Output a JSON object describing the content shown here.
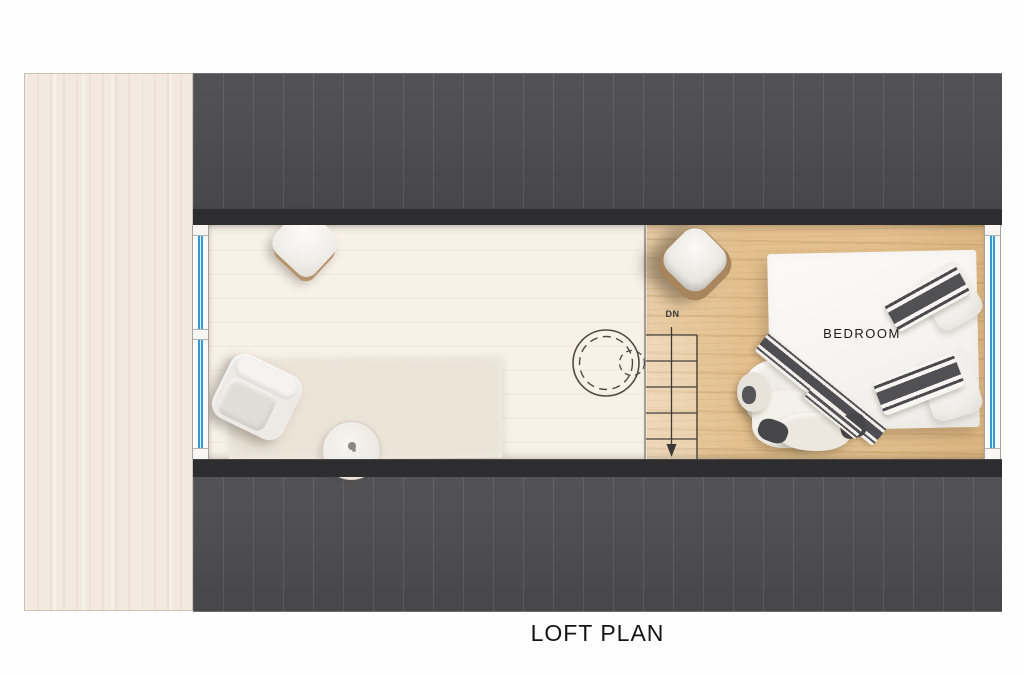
{
  "title": "LOFT PLAN",
  "labels": {
    "bedroom": "BEDROOM",
    "stairs_down": "DN"
  },
  "colors": {
    "window_blue": "#2f9ad5",
    "roof_gray": "#4a4a4d",
    "wall_dark": "#2d2d2f",
    "wood_floor": "#e3c08e",
    "cream_floor": "#f8f1e8",
    "deck_strip": "#f3eadf",
    "rug": "#eae3d6",
    "pillow_stripe_dark": "#4c4c4e",
    "title_color": "#141414"
  },
  "furniture": [
    "floor-cushion",
    "armchair",
    "rug",
    "side-table",
    "hanging-chair-dashed",
    "staircase-down",
    "lounge-chair",
    "double-bed",
    "pillows",
    "duvet"
  ]
}
